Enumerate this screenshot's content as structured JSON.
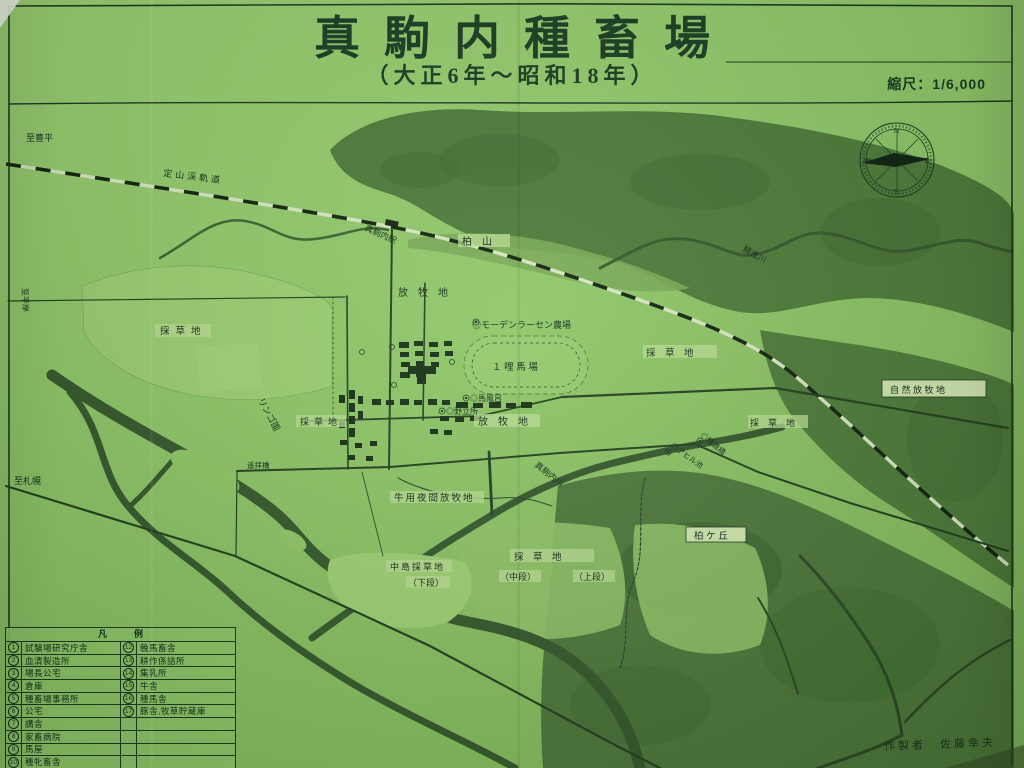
{
  "title": {
    "main": "真駒内種畜場",
    "subtitle": "（大正6年～昭和18年）",
    "scale_label": "縮尺：1/6,000",
    "credit": "作製者　佐藤幸夫"
  },
  "palette": {
    "paper": "#8ec766",
    "forest": "#4d7b39",
    "river": "#35592c",
    "ink": "#1d3b22"
  },
  "compass": {
    "n": "N",
    "e": "E",
    "s": "S",
    "w": "W"
  },
  "map_labels": {
    "to_toyohira": "至豊平",
    "jozankei_tramway": "定山渓軌道",
    "makomanai_station": "真駒内駅",
    "kashiwayama": "柏　山",
    "shojin_river": "精進川",
    "pasture_north": "放　牧　地",
    "larsen_farm": "◎モーデンラーセン農場",
    "one_mile_track": "１ 哩 馬 場",
    "meadow_west": "採草地",
    "meadow_east_upper": "採　草　地",
    "natural_pasture": "自 然 放 牧 地",
    "meadow_east_lower": "採　草　地",
    "horse_bath": "◎馬風呂",
    "nodatesho": "◎野立所",
    "pasture_center": "放　牧　地",
    "apple_orchard": "リンゴ園",
    "meadow_center": "採草地",
    "cattle_night_pasture": "牛用夜間放牧地",
    "makomanai_river": "真駒内川",
    "nakajima_meadow": "中島採草地",
    "tier_lower": "（下段）",
    "meadow_south": "採　草　地",
    "tier_middle": "（中段）",
    "tier_upper": "（上段）",
    "kashiwagaoka": "柏 ケ 丘",
    "shojin_bridge": "◎精進橋",
    "duck_pond": "◎アヒル池",
    "to_hiragishi": "至平岸",
    "to_sapporo": "至札幌",
    "yohai_bridge": "遥拝橋"
  },
  "legend": {
    "header": "凡　　　例",
    "left": [
      {
        "n": "1",
        "t": "試験場研究庁舎"
      },
      {
        "n": "2",
        "t": "血清製造所"
      },
      {
        "n": "3",
        "t": "場長公宅"
      },
      {
        "n": "4",
        "t": "倉庫"
      },
      {
        "n": "5",
        "t": "種畜場事務所"
      },
      {
        "n": "6",
        "t": "公宅"
      },
      {
        "n": "7",
        "t": "講舎"
      },
      {
        "n": "8",
        "t": "家畜病院"
      },
      {
        "n": "9",
        "t": "馬屋"
      },
      {
        "n": "10",
        "t": "種牝畜舎"
      },
      {
        "n": "11",
        "t": "鍛工装蹄所"
      },
      {
        "n": "",
        "t": ""
      }
    ],
    "right": [
      {
        "n": "12",
        "t": "輓馬畜舎"
      },
      {
        "n": "13",
        "t": "耕作係詰所"
      },
      {
        "n": "14",
        "t": "集乳所"
      },
      {
        "n": "15",
        "t": "牛舎"
      },
      {
        "n": "16",
        "t": "種馬舎"
      },
      {
        "n": "17",
        "t": "豚舎,牧草貯蔵庫"
      },
      {
        "n": "",
        "t": ""
      },
      {
        "n": "",
        "t": ""
      },
      {
        "n": "",
        "t": ""
      },
      {
        "n": "",
        "t": ""
      },
      {
        "n": "",
        "t": ""
      },
      {
        "n": "",
        "t": ""
      }
    ]
  }
}
